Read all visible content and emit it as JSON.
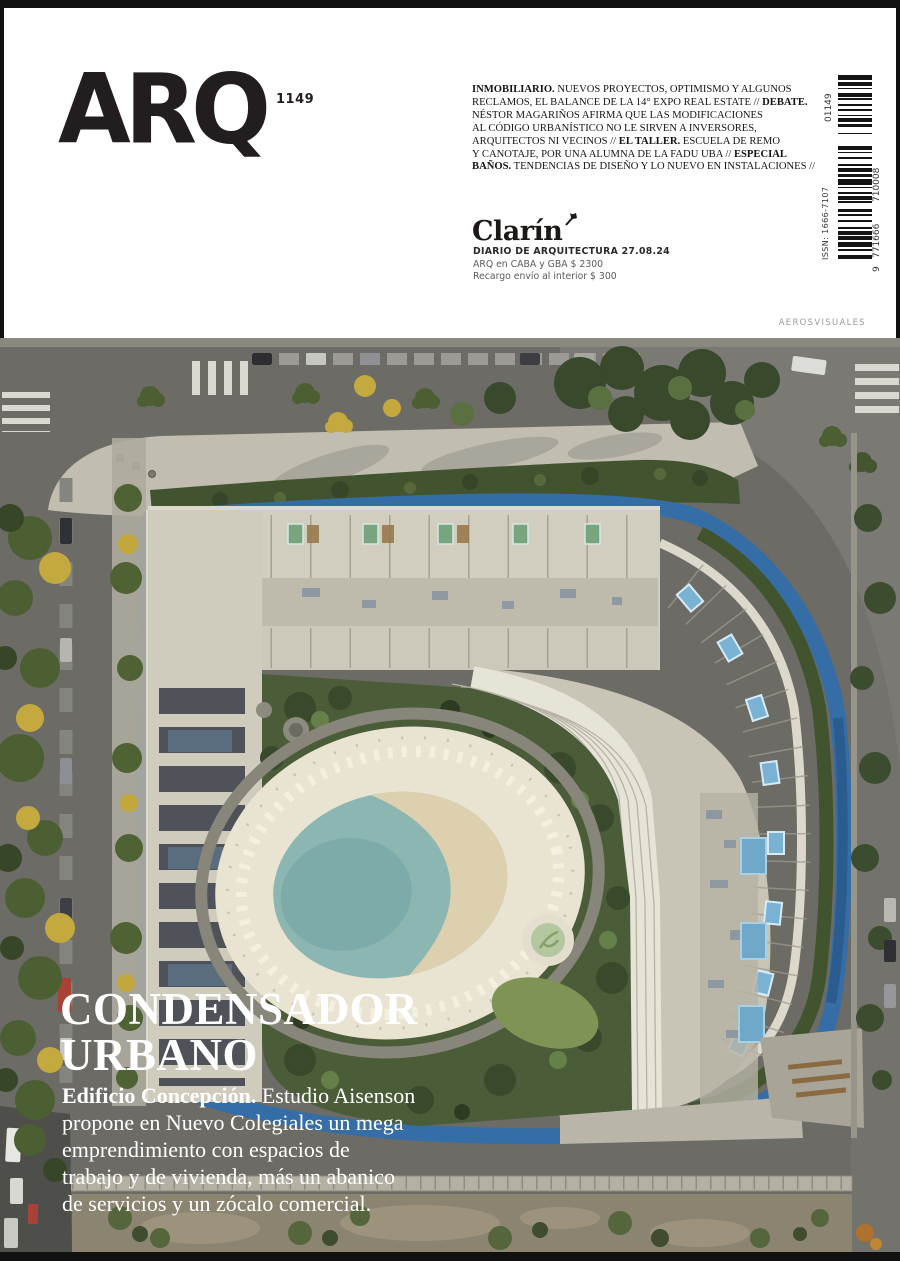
{
  "masthead": {
    "logo": "ARQ",
    "issue_number": "1149",
    "teaser_lines": [
      [
        {
          "t": "INMOBILIARIO.",
          "b": true
        },
        {
          "t": " NUEVOS PROYECTOS, OPTIMISMO Y ALGUNOS",
          "b": false
        }
      ],
      [
        {
          "t": "RECLAMOS, EL BALANCE DE LA 14° EXPO REAL ESTATE // ",
          "b": false
        },
        {
          "t": "DEBATE.",
          "b": true
        }
      ],
      [
        {
          "t": "NÉSTOR MAGARIÑOS AFIRMA QUE LAS MODIFICACIONES",
          "b": false
        }
      ],
      [
        {
          "t": "AL CÓDIGO URBANÍSTICO NO LE SIRVEN A INVERSORES,",
          "b": false
        }
      ],
      [
        {
          "t": "ARQUITECTOS NI VECINOS // ",
          "b": false
        },
        {
          "t": "EL TALLER.",
          "b": true
        },
        {
          "t": " ESCUELA DE REMO",
          "b": false
        }
      ],
      [
        {
          "t": "Y CANOTAJE, POR UNA ALUMNA DE LA FADU UBA // ",
          "b": false
        },
        {
          "t": "ESPECIAL",
          "b": true
        }
      ],
      [
        {
          "t": "BAÑOS.",
          "b": true
        },
        {
          "t": " TENDENCIAS DE DISEÑO Y LO NUEVO EN INSTALACIONES //",
          "b": false
        }
      ]
    ],
    "publisher": {
      "brand": "Clarín",
      "line1": "DIARIO DE ARQUITECTURA 27.08.24",
      "line2": "ARQ en CABA y GBA $ 2300",
      "line3": "Recargo envío al interior $ 300"
    },
    "barcode": {
      "addon_number": "01149",
      "issn": "ISSN: 1666-7107",
      "ean_prefix": "9",
      "ean_group1": "771666",
      "ean_group2": "710008"
    }
  },
  "photo": {
    "credit": "AEROSVISUALES"
  },
  "cover_story": {
    "headline_lines": [
      "CONDENSADOR",
      "URBANO"
    ],
    "dek_lines": [
      [
        {
          "t": "Edificio Concepción.",
          "b": true
        },
        {
          "t": " Estudio Aisenson",
          "b": false
        }
      ],
      [
        {
          "t": "propone en Nuevo Colegiales un mega",
          "b": false
        }
      ],
      [
        {
          "t": "emprendimiento con espacios de",
          "b": false
        }
      ],
      [
        {
          "t": "trabajo y de vivienda, más un abanico",
          "b": false
        }
      ],
      [
        {
          "t": "de servicios y un zócalo comercial.",
          "b": false
        }
      ]
    ]
  },
  "colors": {
    "frame_black": "#111111",
    "logo_black": "#221e1f",
    "path_blue": "#336ea9",
    "pool_water": "#8cb6b1",
    "sand": "#e0d2ae",
    "roof": "#cdc9bb",
    "street": "#6c6b66",
    "vegetation": "#4b5d38",
    "headline_white": "#ffffff"
  }
}
